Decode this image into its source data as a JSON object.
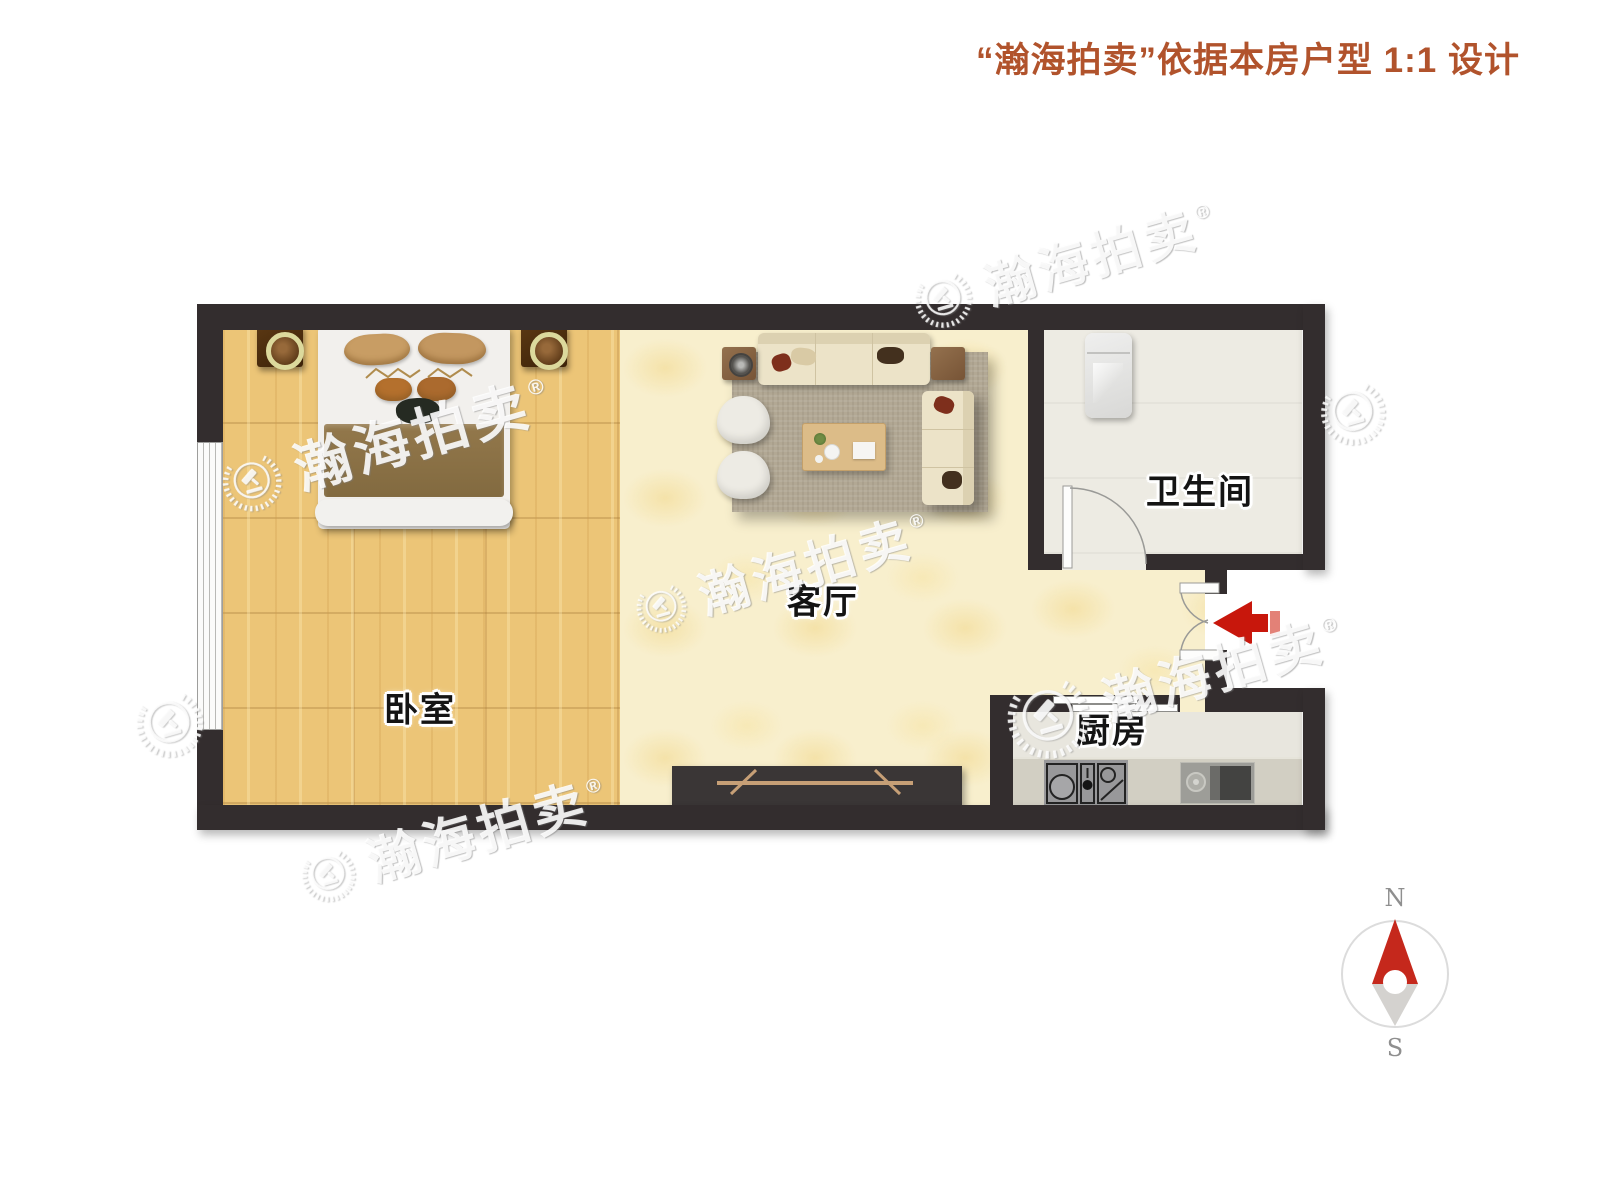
{
  "header": {
    "title": "“瀚海拍卖”依据本房户型 1:1 设计"
  },
  "rooms": {
    "bedroom": {
      "label": "卧室"
    },
    "living": {
      "label": "客厅"
    },
    "bathroom": {
      "label": "卫生间"
    },
    "kitchen": {
      "label": "厨房"
    }
  },
  "watermark": {
    "text": "瀚海拍卖",
    "registered": "®"
  },
  "compass": {
    "north": "N",
    "south": "S"
  },
  "colors": {
    "header_text": "#b1532c",
    "wall": "#332d2e",
    "bedroom_floor": "#ecc577",
    "living_floor": "#f8efcd",
    "entry_arrow_red": "#c8170c",
    "compass_needle_red": "#c5281c"
  }
}
